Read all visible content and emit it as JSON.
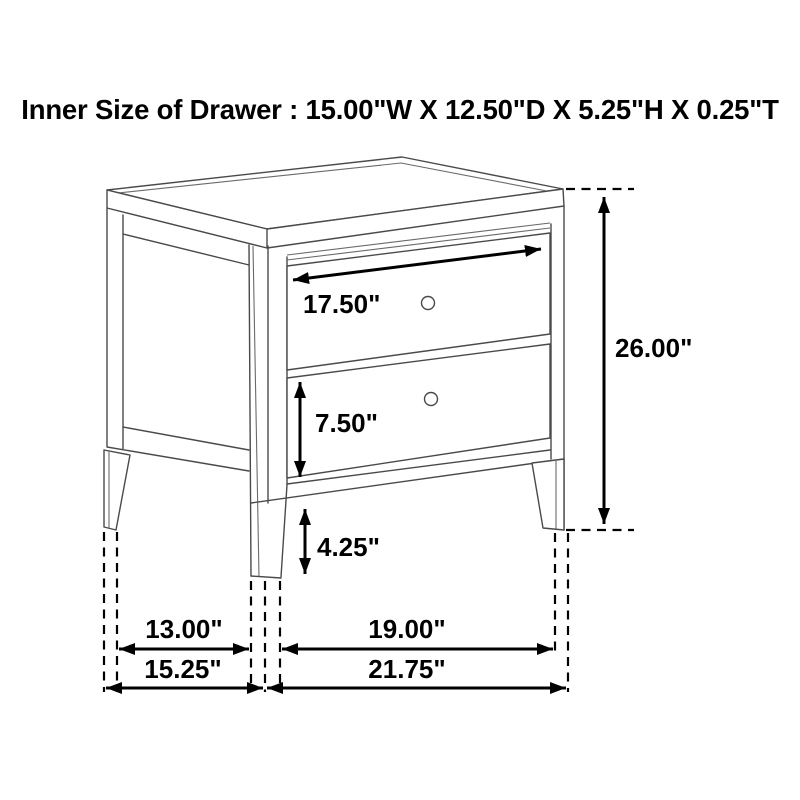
{
  "title": "Inner Size of Drawer : 15.00\"W X 12.50\"D X 5.25\"H X 0.25\"T",
  "dimensions": {
    "drawer_front_width": "17.50\"",
    "overall_height": "26.00\"",
    "drawer_front_height": "7.50\"",
    "leg_clearance_height": "4.25\"",
    "side_inner_depth": "13.00\"",
    "side_overall_depth": "15.25\"",
    "front_inner_width": "19.00\"",
    "front_overall_width": "21.75\""
  },
  "colors": {
    "background": "#ffffff",
    "furniture_line": "#4a4a4a",
    "dimension_line": "#000000",
    "text": "#000000"
  }
}
